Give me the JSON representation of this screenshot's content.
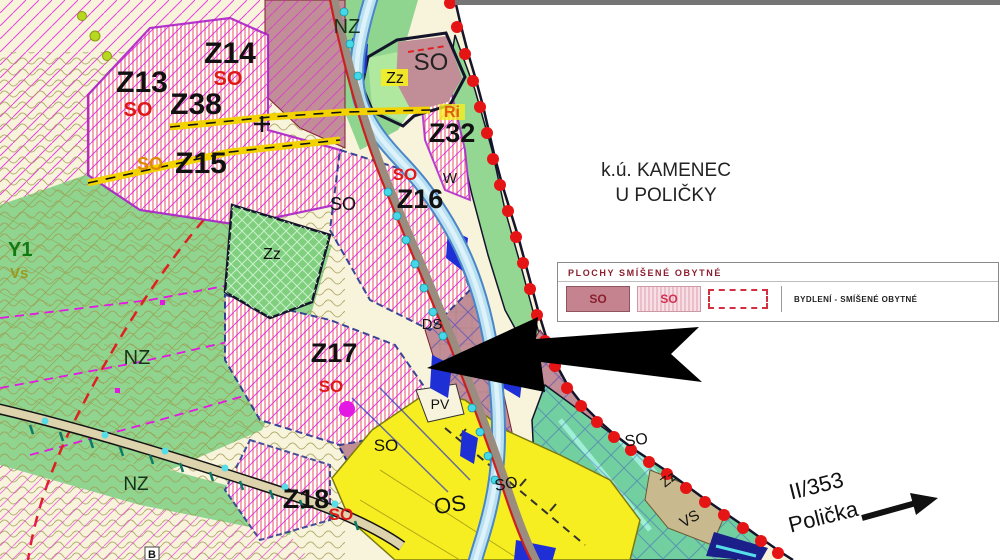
{
  "legend": {
    "title": "PLOCHY SMÍŠENÉ OBYTNÉ",
    "items": [
      {
        "code": "SO",
        "style": "solid"
      },
      {
        "code": "SO",
        "style": "hatched"
      },
      {
        "code": "",
        "style": "dashed-outline"
      }
    ],
    "description": "BYDLENÍ - SMÍŠENÉ OBYTNÉ"
  },
  "map": {
    "labels": [
      {
        "id": "nz-top",
        "text": "NZ",
        "x": 347,
        "y": 33,
        "size": 20,
        "color": "#16341a",
        "bold": false,
        "rotate": 0
      },
      {
        "id": "z14",
        "text": "Z14",
        "x": 230,
        "y": 63,
        "size": 30,
        "color": "#111111",
        "bold": true,
        "rotate": 0
      },
      {
        "id": "so-z14",
        "text": "SO",
        "x": 228,
        "y": 85,
        "size": 20,
        "color": "#e01818",
        "bold": true,
        "rotate": 0
      },
      {
        "id": "z13",
        "text": "Z13",
        "x": 142,
        "y": 92,
        "size": 30,
        "color": "#111111",
        "bold": true,
        "rotate": 0
      },
      {
        "id": "z38",
        "text": "Z38",
        "x": 196,
        "y": 114,
        "size": 30,
        "color": "#111111",
        "bold": true,
        "rotate": 0
      },
      {
        "id": "so-z13",
        "text": "SO",
        "x": 138,
        "y": 116,
        "size": 20,
        "color": "#e01818",
        "bold": true,
        "rotate": 0
      },
      {
        "id": "so-z15",
        "text": "SO",
        "x": 150,
        "y": 170,
        "size": 18,
        "color": "#e08a00",
        "bold": true,
        "rotate": 0
      },
      {
        "id": "z15",
        "text": "Z15",
        "x": 201,
        "y": 173,
        "size": 30,
        "color": "#111111",
        "bold": true,
        "rotate": 0
      },
      {
        "id": "zz-top",
        "text": "Zz",
        "x": 395,
        "y": 83,
        "size": 16,
        "color": "#111111",
        "bold": false,
        "rotate": 0
      },
      {
        "id": "so-top",
        "text": "SO",
        "x": 431,
        "y": 70,
        "size": 24,
        "color": "#222222",
        "bold": false,
        "rotate": 0
      },
      {
        "id": "ri",
        "text": "Ri",
        "x": 452,
        "y": 117,
        "size": 16,
        "color": "#e05a10",
        "bold": true,
        "rotate": 0
      },
      {
        "id": "z32",
        "text": "Z32",
        "x": 452,
        "y": 142,
        "size": 27,
        "color": "#111111",
        "bold": true,
        "rotate": 0
      },
      {
        "id": "so-z16",
        "text": "SO",
        "x": 405,
        "y": 180,
        "size": 17,
        "color": "#e01818",
        "bold": true,
        "rotate": 0
      },
      {
        "id": "w-river",
        "text": "W",
        "x": 450,
        "y": 183,
        "size": 15,
        "color": "#111111",
        "bold": false,
        "rotate": 0
      },
      {
        "id": "z16",
        "text": "Z16",
        "x": 420,
        "y": 208,
        "size": 27,
        "color": "#111111",
        "bold": true,
        "rotate": 0
      },
      {
        "id": "so-mid",
        "text": "SO",
        "x": 343,
        "y": 210,
        "size": 18,
        "color": "#111111",
        "bold": false,
        "rotate": 0
      },
      {
        "id": "zz-mid",
        "text": "Zz",
        "x": 272,
        "y": 259,
        "size": 16,
        "color": "#111111",
        "bold": false,
        "rotate": 0
      },
      {
        "id": "y1-left",
        "text": "Y1",
        "x": 8,
        "y": 256,
        "size": 20,
        "color": "#127a12",
        "bold": true,
        "rotate": 0,
        "anchor": "start"
      },
      {
        "id": "vs-left",
        "text": "Vs",
        "x": 10,
        "y": 278,
        "size": 15,
        "color": "#9a9a20",
        "bold": true,
        "rotate": 0,
        "anchor": "start"
      },
      {
        "id": "nz-left",
        "text": "NZ",
        "x": 137,
        "y": 364,
        "size": 20,
        "color": "#16341a",
        "bold": false,
        "rotate": 0
      },
      {
        "id": "z17",
        "text": "Z17",
        "x": 334,
        "y": 362,
        "size": 27,
        "color": "#111111",
        "bold": true,
        "rotate": 0
      },
      {
        "id": "so-z17",
        "text": "SO",
        "x": 331,
        "y": 392,
        "size": 17,
        "color": "#e01818",
        "bold": true,
        "rotate": 0
      },
      {
        "id": "ds",
        "text": "DS",
        "x": 432,
        "y": 329,
        "size": 15,
        "color": "#111111",
        "bold": false,
        "rotate": 0
      },
      {
        "id": "pv",
        "text": "PV",
        "x": 440,
        "y": 409,
        "size": 14,
        "color": "#111111",
        "bold": false,
        "rotate": 0
      },
      {
        "id": "so-sw",
        "text": "SO",
        "x": 386,
        "y": 451,
        "size": 17,
        "color": "#111111",
        "bold": false,
        "rotate": 0
      },
      {
        "id": "nz-bottom",
        "text": "NZ",
        "x": 136,
        "y": 490,
        "size": 19,
        "color": "#16341a",
        "bold": false,
        "rotate": 0
      },
      {
        "id": "z18",
        "text": "Z18",
        "x": 306,
        "y": 508,
        "size": 27,
        "color": "#111111",
        "bold": true,
        "rotate": 0
      },
      {
        "id": "so-z18",
        "text": "SO",
        "x": 341,
        "y": 520,
        "size": 17,
        "color": "#e01818",
        "bold": true,
        "rotate": 0
      },
      {
        "id": "os",
        "text": "OS",
        "x": 451,
        "y": 512,
        "size": 22,
        "color": "#111111",
        "bold": false,
        "rotate": -8
      },
      {
        "id": "so-os",
        "text": "SO",
        "x": 507,
        "y": 489,
        "size": 16,
        "color": "#111111",
        "bold": false,
        "rotate": -10
      },
      {
        "id": "so-se",
        "text": "SO",
        "x": 637,
        "y": 445,
        "size": 16,
        "color": "#111111",
        "bold": false,
        "rotate": -8
      },
      {
        "id": "zz-se",
        "text": "Zz",
        "x": 671,
        "y": 483,
        "size": 14,
        "color": "#111111",
        "bold": false,
        "rotate": -38
      },
      {
        "id": "vs-se",
        "text": "VS",
        "x": 692,
        "y": 523,
        "size": 15,
        "color": "#111111",
        "bold": false,
        "rotate": -30
      },
      {
        "id": "b-bottom",
        "text": "B",
        "x": 152,
        "y": 558,
        "size": 11,
        "color": "#111111",
        "bold": true,
        "rotate": 0
      },
      {
        "id": "region-title-1",
        "text": "k.ú. KAMENEC",
        "x": 666,
        "y": 176,
        "size": 19,
        "color": "#222222",
        "bold": false,
        "rotate": 0
      },
      {
        "id": "region-title-2",
        "text": "U POLIČKY",
        "x": 666,
        "y": 201,
        "size": 19,
        "color": "#222222",
        "bold": false,
        "rotate": 0
      },
      {
        "id": "road-ref",
        "text": "II/353",
        "x": 818,
        "y": 493,
        "size": 22,
        "color": "#111111",
        "bold": false,
        "rotate": -14
      },
      {
        "id": "road-dest",
        "text": "Polička",
        "x": 825,
        "y": 524,
        "size": 22,
        "color": "#111111",
        "bold": false,
        "rotate": -14
      }
    ]
  }
}
